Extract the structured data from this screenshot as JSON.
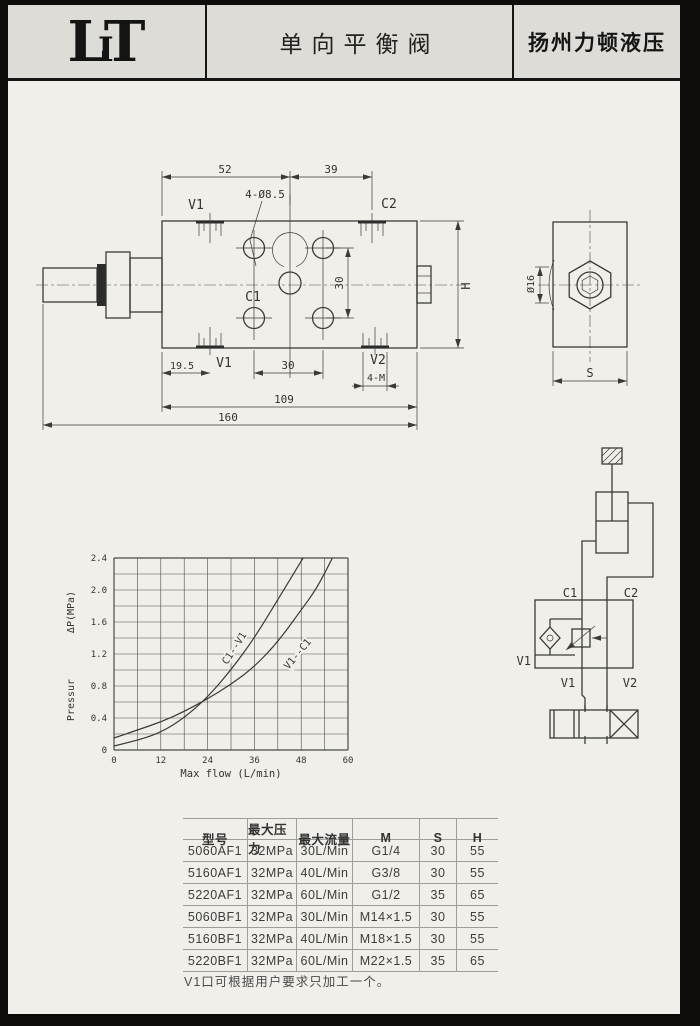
{
  "colors": {
    "paper": "#f1efe9",
    "header_band": "#dedcd6",
    "ink": "#3a3a3a",
    "frame": "#0d0c0a"
  },
  "header": {
    "logo": [
      "L",
      "I",
      "T"
    ],
    "title": "单向平衡阀",
    "company": "扬州力顿液压"
  },
  "front_view": {
    "dim_52": "52",
    "dim_39": "39",
    "holes_callout": "4-Ø8.5",
    "port_v1_top": "V1",
    "port_c2": "C2",
    "port_c1": "C1",
    "dim_30_vert": "30",
    "dim_h": "H",
    "dim_19_5": "19.5",
    "port_v1_bottom": "V1",
    "dim_30_bottom": "30",
    "port_v2": "V2",
    "dim_4m": "4-M",
    "dim_109": "109",
    "dim_160": "160"
  },
  "side_view": {
    "dim_dia16": "Ø16",
    "dim_s": "S"
  },
  "circuit": {
    "c1": "C1",
    "c2": "C2",
    "v1_side": "V1",
    "v1_bottom": "V1",
    "v2_bottom": "V2"
  },
  "chart_data": {
    "type": "line",
    "title": "",
    "xlabel": "Max flow (L/min)",
    "ylabel": "Pressur ΔP(MPa)",
    "ylabel_upper": "ΔP(MPa)",
    "ylabel_lower": "Pressur",
    "xlim": [
      0,
      60
    ],
    "ylim": [
      0,
      2.4
    ],
    "x_grid_step": 6,
    "y_grid_step": 0.2,
    "grid": true,
    "legend_position": "labels-on-curves",
    "xticks": [
      {
        "v": 0,
        "label": "0"
      },
      {
        "v": 12,
        "label": "12"
      },
      {
        "v": 24,
        "label": "24"
      },
      {
        "v": 36,
        "label": "36"
      },
      {
        "v": 48,
        "label": "48"
      },
      {
        "v": 60,
        "label": "60"
      }
    ],
    "yticks": [
      {
        "v": 0,
        "label": "0"
      },
      {
        "v": 0.4,
        "label": "0.4"
      },
      {
        "v": 0.8,
        "label": "0.8"
      },
      {
        "v": 1.2,
        "label": "1.2"
      },
      {
        "v": 1.6,
        "label": "1.6"
      },
      {
        "v": 2.0,
        "label": "2.0"
      },
      {
        "v": 2.4,
        "label": "2.4"
      }
    ],
    "series": [
      {
        "name": "C1--V1",
        "points": [
          [
            0,
            0.05
          ],
          [
            6,
            0.12
          ],
          [
            12,
            0.22
          ],
          [
            18,
            0.4
          ],
          [
            24,
            0.66
          ],
          [
            30,
            1.0
          ],
          [
            36,
            1.4
          ],
          [
            42,
            1.88
          ],
          [
            48,
            2.36
          ],
          [
            48.5,
            2.4
          ]
        ]
      },
      {
        "name": "V1--C1",
        "points": [
          [
            0,
            0.15
          ],
          [
            6,
            0.25
          ],
          [
            12,
            0.35
          ],
          [
            18,
            0.48
          ],
          [
            24,
            0.64
          ],
          [
            30,
            0.82
          ],
          [
            36,
            1.04
          ],
          [
            42,
            1.35
          ],
          [
            48,
            1.75
          ],
          [
            52,
            2.02
          ],
          [
            56,
            2.4
          ]
        ]
      }
    ]
  },
  "table": {
    "headers": [
      "型号",
      "最大压力",
      "最大流量",
      "M",
      "S",
      "H"
    ],
    "rows": [
      [
        "5060AF1",
        "32MPa",
        "30L/Min",
        "G1/4",
        "30",
        "55"
      ],
      [
        "5160AF1",
        "32MPa",
        "40L/Min",
        "G3/8",
        "30",
        "55"
      ],
      [
        "5220AF1",
        "32MPa",
        "60L/Min",
        "G1/2",
        "35",
        "65"
      ],
      [
        "5060BF1",
        "32MPa",
        "30L/Min",
        "M14×1.5",
        "30",
        "55"
      ],
      [
        "5160BF1",
        "32MPa",
        "40L/Min",
        "M18×1.5",
        "30",
        "55"
      ],
      [
        "5220BF1",
        "32MPa",
        "60L/Min",
        "M22×1.5",
        "35",
        "65"
      ]
    ]
  },
  "note": "V1口可根据用户要求只加工一个。"
}
